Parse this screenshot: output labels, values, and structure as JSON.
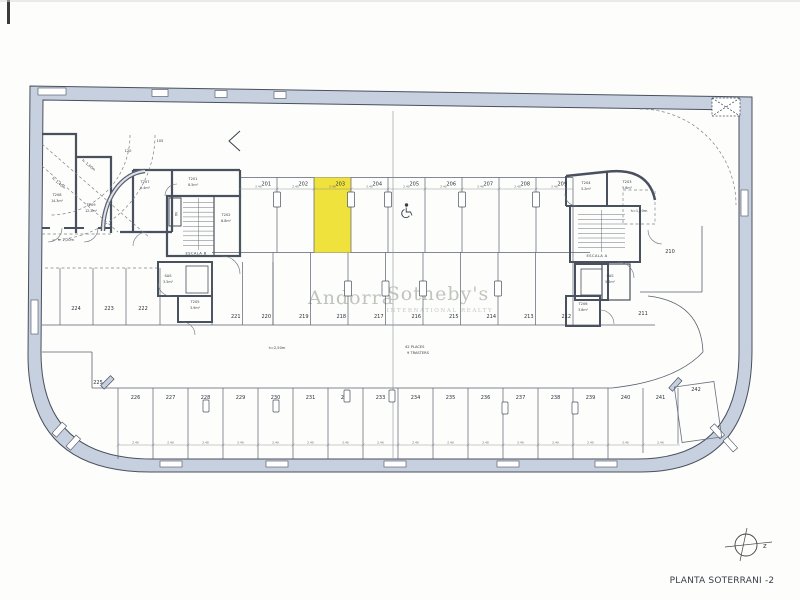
{
  "title": "PLANTA SOTERRANI -2",
  "watermark": {
    "brand_left": "Andorra",
    "brand_right": "Sotheby's",
    "subtitle": "INTERNATIONAL REALTY"
  },
  "compass": {
    "axis_label": "z"
  },
  "capacity": {
    "places": "42 PLACES",
    "trasters": "9 TRASTERS"
  },
  "highlight": {
    "space": "203",
    "color": "#f0e23c"
  },
  "parking": {
    "top_row": [
      "201",
      "202",
      "203",
      "204",
      "205",
      "206",
      "207",
      "208",
      "209"
    ],
    "middle_row": [
      "219",
      "218",
      "217",
      "216",
      "215",
      "214",
      "213",
      "212"
    ],
    "middle_left": [
      "221",
      "220"
    ],
    "left_column": [
      "224",
      "223",
      "222"
    ],
    "single_spaces": {
      "upper_right": "210",
      "right": "211",
      "corner_left": "225",
      "tilted_right": "242"
    },
    "bottom_row": [
      "226",
      "227",
      "228",
      "229",
      "230",
      "231",
      "232",
      "233",
      "234",
      "235",
      "236",
      "237",
      "238",
      "239",
      "240",
      "241"
    ]
  },
  "rooms": [
    {
      "id": "T208",
      "area": "14.3m²"
    },
    {
      "id": "T209",
      "area": "12.2m²"
    },
    {
      "id": "T207",
      "area": "9.4m²"
    },
    {
      "id": "T201",
      "area": "8.5m²"
    },
    {
      "id": "T202",
      "area": "6.8m²"
    },
    {
      "id": "SAS",
      "area": "3.5m²"
    },
    {
      "id": "T205",
      "area": "3.9m²"
    },
    {
      "id": "T204",
      "area": "5.2m²"
    },
    {
      "id": "T203",
      "area": "5.8m²"
    },
    {
      "id": "SAS",
      "area": "5.2m²"
    },
    {
      "id": "T206",
      "area": "3.8m²"
    }
  ],
  "stairs": [
    {
      "label": "ESCALA B"
    },
    {
      "label": "ESCALA A"
    }
  ],
  "elevator_label": "VA",
  "annotations": [
    {
      "id": "h-diag-low",
      "text": "h: 1,40m"
    },
    {
      "id": "h-diag-high",
      "text": "h: 1,60m"
    },
    {
      "id": "h-store",
      "text": "h: 2,20m"
    },
    {
      "id": "radius-120",
      "text": "120"
    },
    {
      "id": "radius-105",
      "text": "105"
    },
    {
      "id": "h-aisle",
      "text": "h=2,50m"
    },
    {
      "id": "h-right",
      "text": "h=1,50m"
    }
  ],
  "dimensions": {
    "typical": "2.40"
  },
  "colors": {
    "wall_fill": "#c7d0df",
    "line_dark": "#49505e",
    "line_thin": "#6b7280",
    "highlight": "#f0e23c",
    "watermark": "#b6bbb3"
  }
}
